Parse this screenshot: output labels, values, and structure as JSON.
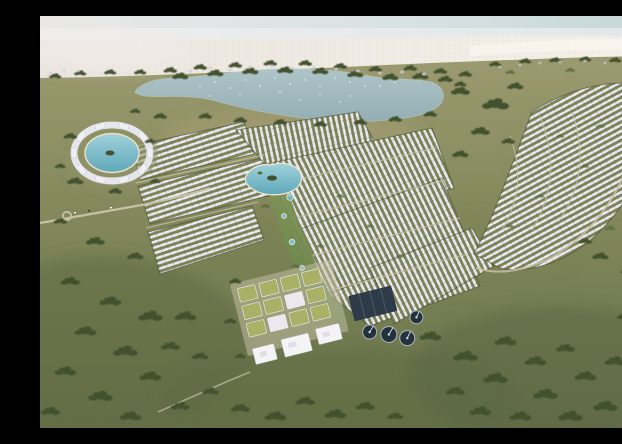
{
  "meta": {
    "title": "Aerial rendering of coastal master-planned residential community",
    "description": "Aerial architectural rendering: white villa clusters around a central lagoon park, an oval lagoon resort ring, a large natural lake, beachfront dunes along the sea, civic blocks with green roofs, a water-treatment plant with circular tanks, all surrounded by olive-green fields and tree clusters."
  },
  "colors": {
    "sky-left": "#e9e8e7",
    "sky-right": "#c6d6da",
    "sea-left": "#efedec",
    "sea-right": "#e0e8ea",
    "sand-left": "#eae4dd",
    "sand-right": "#f4f0e8",
    "sand-speckle": "#d5c9b4",
    "grass-light": "#9c9a70",
    "grass-mid": "#81875a",
    "grass-dark": "#67714a",
    "tree": "#42512e",
    "tree-light": "#5a6b3d",
    "lake-top": "#adc5c8",
    "lake-bottom": "#95aeb4",
    "sparkle": "#ffffff",
    "pool": "#7fc2cf",
    "pool-deep": "#5fa8ba",
    "pool-rim": "#ece3d0",
    "villa": "#eae9f1",
    "block": "#7e8459",
    "road": "#c7c1a7",
    "building-white": "#f4f4f6",
    "roof-green": "#a9b166",
    "basin": "#2c3b47",
    "tank": "#24323e",
    "tank-rim": "#aab4bc",
    "hut": "#ccd0d6",
    "park-top": "#829659",
    "park-bottom": "#657f48"
  },
  "features": {
    "sky": "hazy sky",
    "sea": "sea at horizon",
    "beach": "white sand dunes",
    "lake": "large natural lake",
    "scrub": "shoreline scrub and beach huts",
    "resort": "oval lagoon resort ring",
    "villas": "white villa row districts",
    "central_lagoon": "central amenity lagoon",
    "park": "linear park with pools",
    "civic": "green-roof civic blocks",
    "schools": "large white flat-roof buildings",
    "treatment": "water-treatment basins and circular tanks",
    "roads": "access roads and roundabout",
    "fields": "olive-green fields",
    "trees": "tree clusters",
    "pond": "small pond"
  }
}
